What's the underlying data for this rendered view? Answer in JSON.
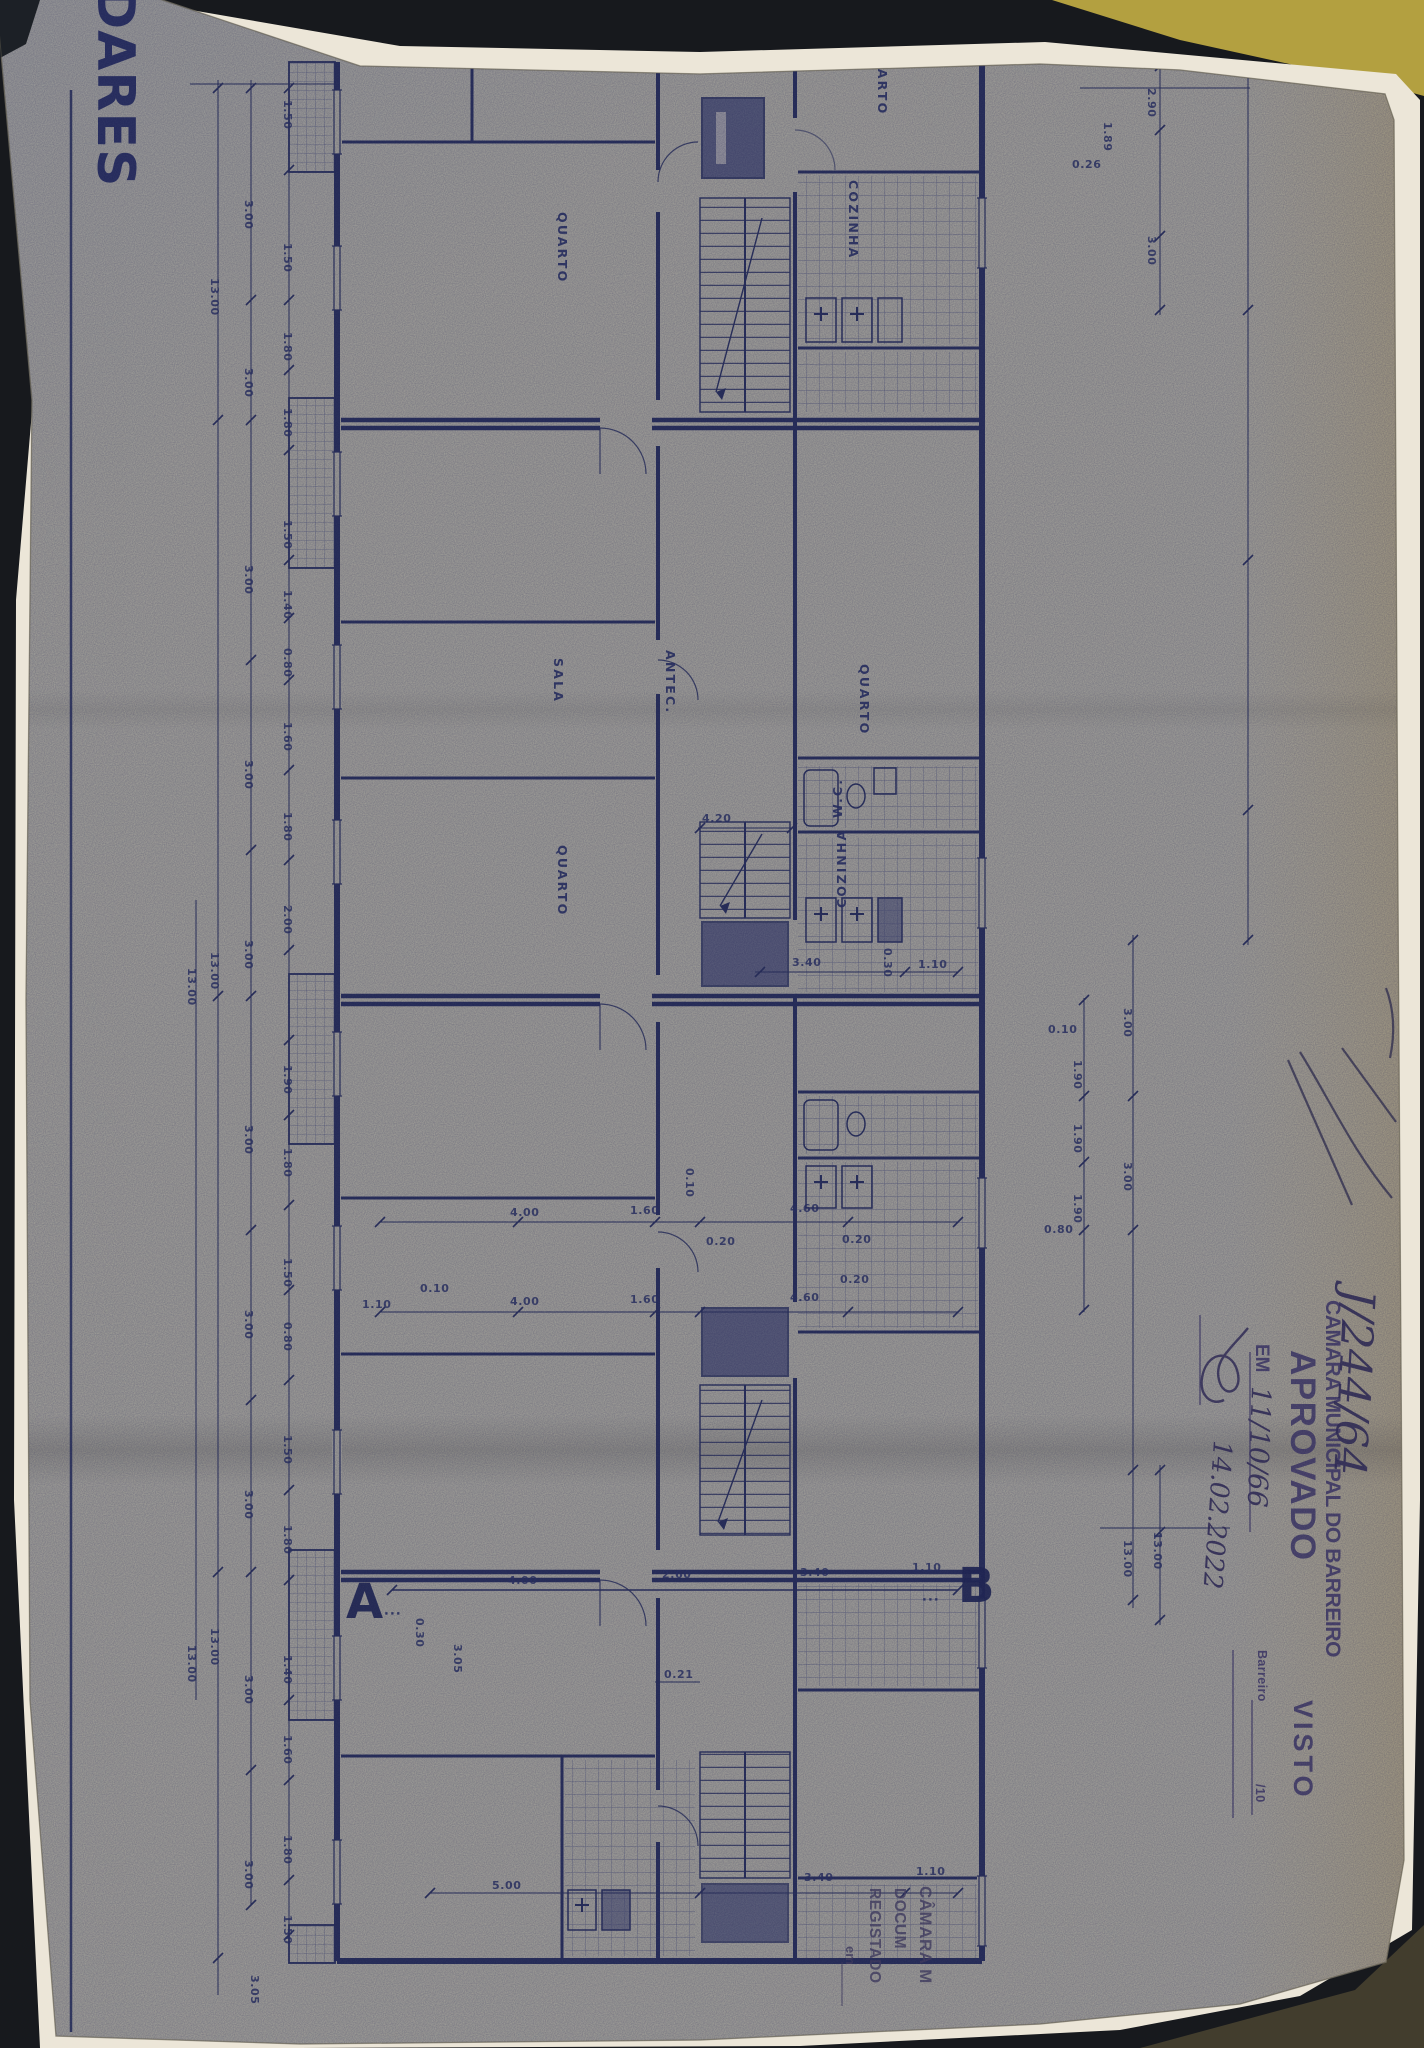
{
  "photo": {
    "surface_color": "#17191d",
    "table_color": "#423d2d",
    "object_top_right_color": "#b3a040",
    "backing_paper_color": "#ece6d8",
    "sheet_color": "#a6a59c",
    "ink_color": "#2e355e",
    "stamp_ink_color": "#47406b"
  },
  "title_block": {
    "text": "DARES"
  },
  "stamps": {
    "file_number": "J/244/64",
    "approval": {
      "line1": "CÂMARA MUNICIPAL DO BARREIRO",
      "line2": "APROVADO",
      "line3_prefix": "EM",
      "line3_handwritten": "11/10/66",
      "date_handwritten": "14.02.2022",
      "place_label": "Barreiro",
      "place_suffix": "/10"
    },
    "visto": "VISTO",
    "registry": {
      "line1": "CÂMARA M",
      "line2": "DOCUM",
      "line3": "REGISTADO",
      "line4": "em"
    }
  },
  "plan": {
    "room_labels": [
      {
        "t": "QUARTO",
        "x": 878,
        "y": 44,
        "r": 90
      },
      {
        "t": "COZINHA",
        "x": 849,
        "y": 180,
        "r": 90
      },
      {
        "t": "QUARTO",
        "x": 558,
        "y": 212,
        "r": 90
      },
      {
        "t": "SALA",
        "x": 554,
        "y": 658,
        "r": 90
      },
      {
        "t": "ANTEC.",
        "x": 666,
        "y": 650,
        "r": 90
      },
      {
        "t": "QUARTO",
        "x": 860,
        "y": 664,
        "r": 90
      },
      {
        "t": "W.C.",
        "x": 842,
        "y": 818,
        "r": -90
      },
      {
        "t": "COZINHA",
        "x": 846,
        "y": 908,
        "r": -90
      },
      {
        "t": "QUARTO",
        "x": 558,
        "y": 845,
        "r": 90
      }
    ],
    "section_markers": [
      {
        "t": "A",
        "x": 346,
        "y": 1618
      },
      {
        "t": "B",
        "x": 958,
        "y": 1602
      }
    ],
    "section_dots": [
      {
        "t": "∙∙∙",
        "x": 384,
        "y": 1618
      },
      {
        "t": "∙∙∙",
        "x": 922,
        "y": 1604
      }
    ],
    "dimensions": [
      {
        "t": "1.50",
        "x": 284,
        "y": 100,
        "r": 90
      },
      {
        "t": "1.50",
        "x": 284,
        "y": 243,
        "r": 90
      },
      {
        "t": "1.80",
        "x": 284,
        "y": 332,
        "r": 90
      },
      {
        "t": "1.80",
        "x": 284,
        "y": 408,
        "r": 90
      },
      {
        "t": "1.50",
        "x": 284,
        "y": 520,
        "r": 90
      },
      {
        "t": "1.40",
        "x": 284,
        "y": 590,
        "r": 90
      },
      {
        "t": "0.80",
        "x": 284,
        "y": 648,
        "r": 90
      },
      {
        "t": "1.60",
        "x": 284,
        "y": 722,
        "r": 90
      },
      {
        "t": "1.80",
        "x": 284,
        "y": 812,
        "r": 90
      },
      {
        "t": "2.00",
        "x": 284,
        "y": 905,
        "r": 90
      },
      {
        "t": "1.90",
        "x": 284,
        "y": 1065,
        "r": 90
      },
      {
        "t": "1.80",
        "x": 284,
        "y": 1148,
        "r": 90
      },
      {
        "t": "1.50",
        "x": 284,
        "y": 1258,
        "r": 90
      },
      {
        "t": "0.80",
        "x": 284,
        "y": 1322,
        "r": 90
      },
      {
        "t": "1.50",
        "x": 284,
        "y": 1435,
        "r": 90
      },
      {
        "t": "1.80",
        "x": 284,
        "y": 1525,
        "r": 90
      },
      {
        "t": "1.40",
        "x": 284,
        "y": 1655,
        "r": 90
      },
      {
        "t": "1.60",
        "x": 284,
        "y": 1735,
        "r": 90
      },
      {
        "t": "1.80",
        "x": 284,
        "y": 1835,
        "r": 90
      },
      {
        "t": "1.50",
        "x": 284,
        "y": 1915,
        "r": 90
      },
      {
        "t": "3.00",
        "x": 245,
        "y": 200,
        "r": 90
      },
      {
        "t": "3.00",
        "x": 245,
        "y": 368,
        "r": 90
      },
      {
        "t": "3.00",
        "x": 245,
        "y": 565,
        "r": 90
      },
      {
        "t": "3.00",
        "x": 245,
        "y": 760,
        "r": 90
      },
      {
        "t": "3.00",
        "x": 245,
        "y": 940,
        "r": 90
      },
      {
        "t": "3.00",
        "x": 245,
        "y": 1125,
        "r": 90
      },
      {
        "t": "3.00",
        "x": 245,
        "y": 1310,
        "r": 90
      },
      {
        "t": "3.00",
        "x": 245,
        "y": 1490,
        "r": 90
      },
      {
        "t": "3.00",
        "x": 245,
        "y": 1675,
        "r": 90
      },
      {
        "t": "3.00",
        "x": 245,
        "y": 1860,
        "r": 90
      },
      {
        "t": "13.00",
        "x": 211,
        "y": 278,
        "r": 90
      },
      {
        "t": "13.00",
        "x": 211,
        "y": 952,
        "r": 90
      },
      {
        "t": "13.00",
        "x": 211,
        "y": 1628,
        "r": 90
      },
      {
        "t": "13.00",
        "x": 188,
        "y": 968,
        "r": 90
      },
      {
        "t": "13.00",
        "x": 188,
        "y": 1645,
        "r": 90
      },
      {
        "t": "3.05",
        "x": 251,
        "y": 1975,
        "r": 90
      },
      {
        "t": "2.90",
        "x": 1148,
        "y": 88,
        "r": 90
      },
      {
        "t": "3.00",
        "x": 1148,
        "y": 236,
        "r": 90
      },
      {
        "t": "1.89",
        "x": 1104,
        "y": 122,
        "r": 90
      },
      {
        "t": "3.00",
        "x": 1124,
        "y": 1008,
        "r": 90
      },
      {
        "t": "3.00",
        "x": 1124,
        "y": 1162,
        "r": 90
      },
      {
        "t": "13.00",
        "x": 1124,
        "y": 1540,
        "r": 90
      },
      {
        "t": "13.00",
        "x": 1154,
        "y": 1532,
        "r": 90
      },
      {
        "t": "1.90",
        "x": 1074,
        "y": 1060,
        "r": 90
      },
      {
        "t": "1.90",
        "x": 1074,
        "y": 1124,
        "r": 90
      },
      {
        "t": "1.90",
        "x": 1074,
        "y": 1194,
        "r": 90
      },
      {
        "t": "0.26",
        "x": 1072,
        "y": 168,
        "r": 0
      },
      {
        "t": "0.10",
        "x": 1048,
        "y": 1033,
        "r": 0
      },
      {
        "t": "0.80",
        "x": 1044,
        "y": 1233,
        "r": 0
      },
      {
        "t": "4.00",
        "x": 510,
        "y": 1216,
        "r": 0
      },
      {
        "t": "1.60",
        "x": 630,
        "y": 1214,
        "r": 0
      },
      {
        "t": "4.60",
        "x": 790,
        "y": 1212,
        "r": 0
      },
      {
        "t": "0.20",
        "x": 706,
        "y": 1245,
        "r": 0
      },
      {
        "t": "0.20",
        "x": 842,
        "y": 1243,
        "r": 0
      },
      {
        "t": "0.10",
        "x": 420,
        "y": 1292,
        "r": 0
      },
      {
        "t": "1.10",
        "x": 362,
        "y": 1308,
        "r": 0
      },
      {
        "t": "4.00",
        "x": 510,
        "y": 1305,
        "r": 0
      },
      {
        "t": "1.60",
        "x": 630,
        "y": 1303,
        "r": 0
      },
      {
        "t": "4.60",
        "x": 790,
        "y": 1301,
        "r": 0
      },
      {
        "t": "0.20",
        "x": 840,
        "y": 1283,
        "r": 0
      },
      {
        "t": "4.00",
        "x": 508,
        "y": 1584,
        "r": 0
      },
      {
        "t": "2.60",
        "x": 662,
        "y": 1578,
        "r": 0
      },
      {
        "t": "3.40",
        "x": 800,
        "y": 1576,
        "r": 0
      },
      {
        "t": "1.10",
        "x": 912,
        "y": 1571,
        "r": 0
      },
      {
        "t": "3.40",
        "x": 792,
        "y": 966,
        "r": 0
      },
      {
        "t": "1.10",
        "x": 918,
        "y": 968,
        "r": 0
      },
      {
        "t": "4.20",
        "x": 702,
        "y": 822,
        "r": 0
      },
      {
        "t": "0.21",
        "x": 664,
        "y": 1678,
        "r": 0
      },
      {
        "t": "5.00",
        "x": 492,
        "y": 1889,
        "r": 0
      },
      {
        "t": "3.40",
        "x": 804,
        "y": 1881,
        "r": 0
      },
      {
        "t": "1.10",
        "x": 916,
        "y": 1875,
        "r": 0
      },
      {
        "t": "0.10",
        "x": 686,
        "y": 1168,
        "r": 90
      },
      {
        "t": "0.30",
        "x": 884,
        "y": 948,
        "r": 90
      },
      {
        "t": "0.30",
        "x": 416,
        "y": 1618,
        "r": 90
      },
      {
        "t": "3.05",
        "x": 454,
        "y": 1644,
        "r": 90
      }
    ]
  }
}
